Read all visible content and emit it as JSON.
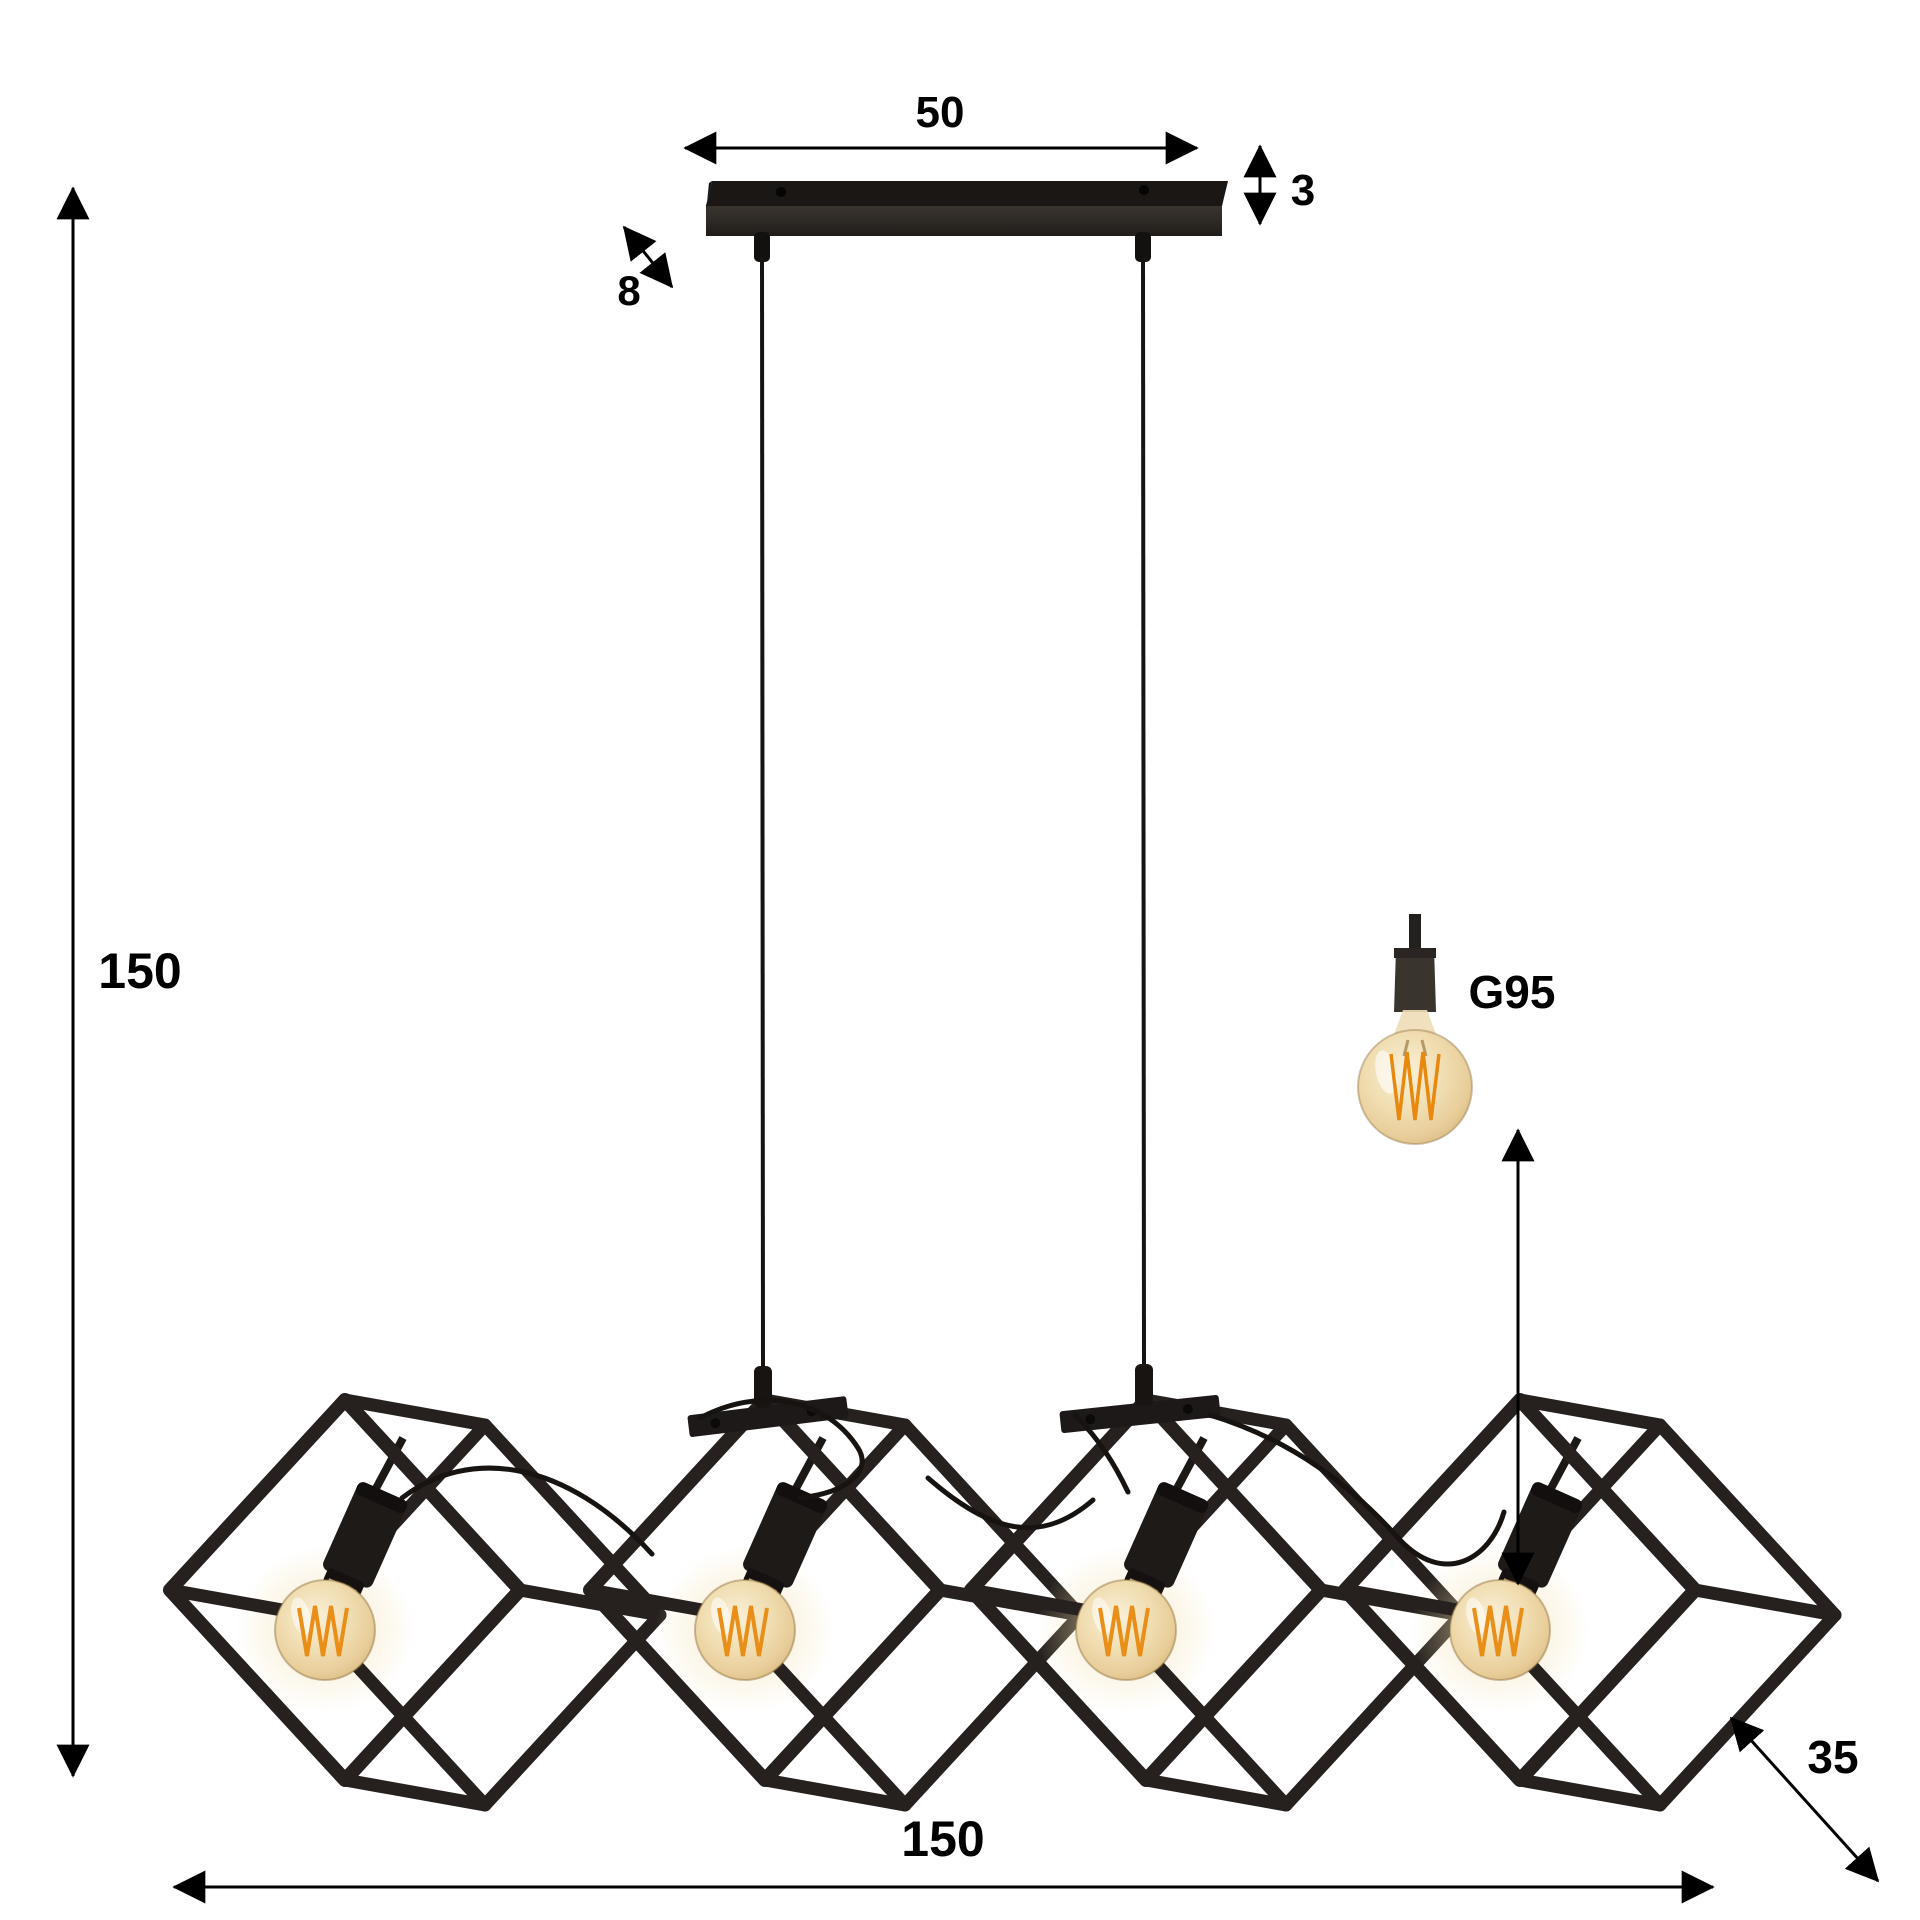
{
  "diagram": {
    "type": "product-dimension-diagram",
    "product": "Industrial pendant lamp with 4 open metal cube shades and filament bulbs",
    "background": "#ffffff"
  },
  "labels": {
    "mount_width": "50",
    "mount_thickness": "3",
    "mount_depth": "8",
    "hanging_height": "150",
    "total_width": "150",
    "cube_depth": "35",
    "bulb_type": "G95"
  },
  "lamp": {
    "cube_count": 4,
    "bulb_count": 4,
    "suspension_cable_count": 2,
    "frame_color": "#26211e",
    "mount_bar_color": "#1a1715",
    "bulb_glass_color": "#eed7a8",
    "filament_color": "#e8890f",
    "dimension_line_color": "#000000"
  }
}
